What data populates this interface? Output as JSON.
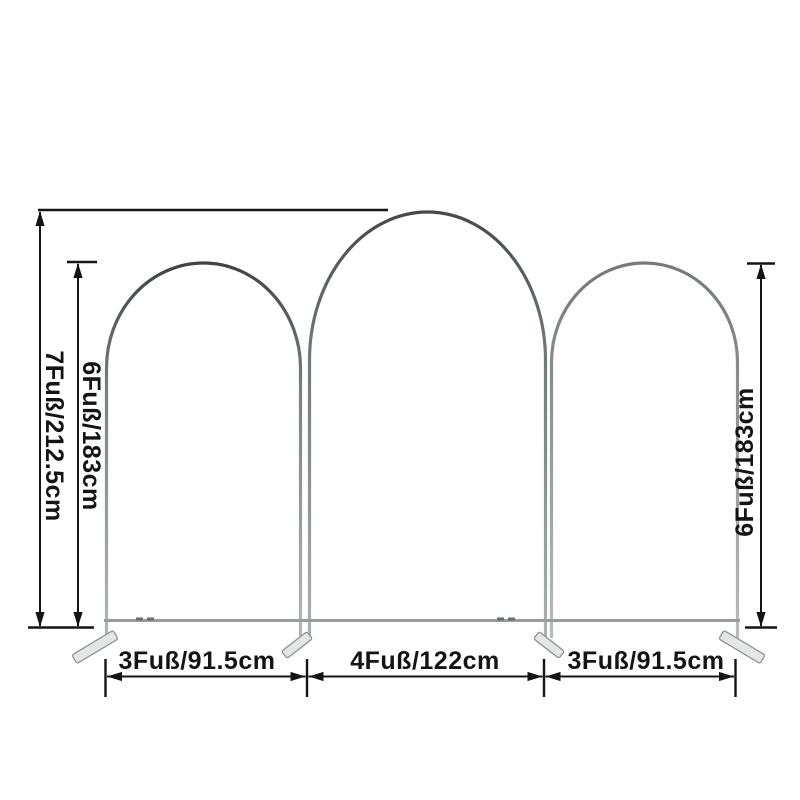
{
  "diagram": {
    "background": "#ffffff",
    "annotation_color": "#141414",
    "frame_color_dark": "#3f4345",
    "frame_color_mid": "#6f7476",
    "frame_color_light": "#b6babc",
    "foot_color": "#e4e6e7",
    "labels": {
      "total_height": "7Fuß/212.5cm",
      "left_arch_height": "6Fuß/183cm",
      "right_arch_height": "6Fuß/183cm",
      "left_arch_width": "3Fuß/91.5cm",
      "middle_arch_width": "4Fuß/122cm",
      "right_arch_width": "3Fuß/91.5cm"
    }
  }
}
